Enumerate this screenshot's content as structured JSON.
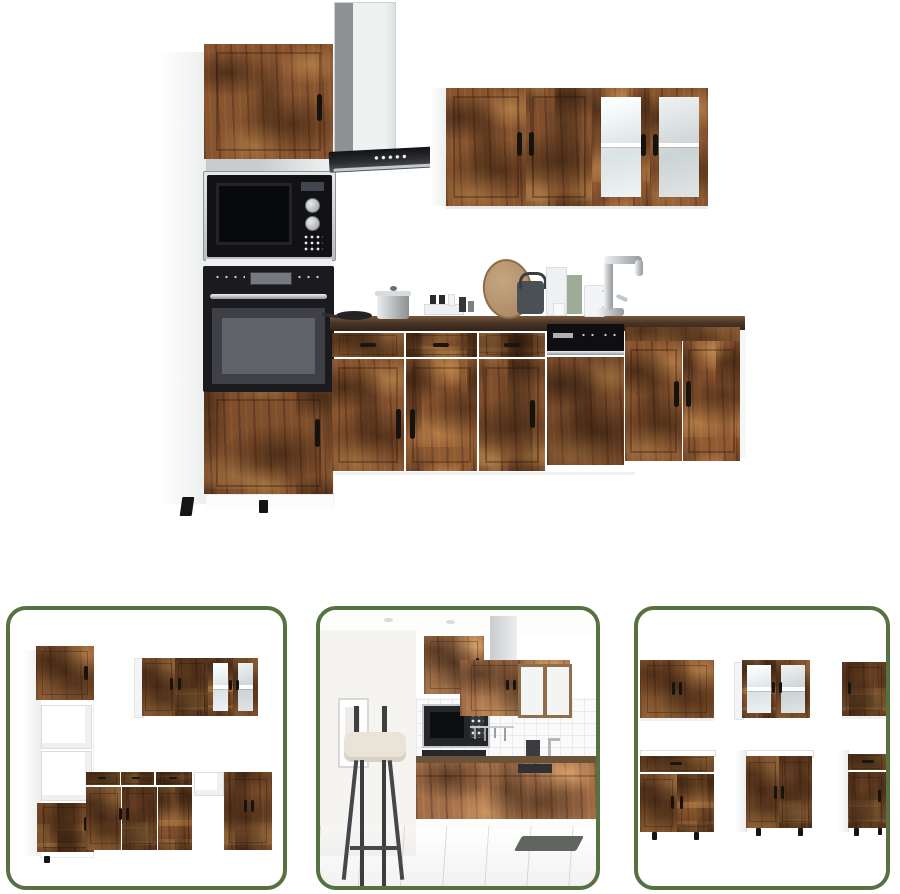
{
  "page": {
    "kind": "product-image-gallery",
    "background": "#ffffff"
  },
  "palette": {
    "green": "#567240",
    "wood_mid": "#875430",
    "counter_dark": "#4a3626",
    "appliance_black": "#141417",
    "steel": "#c9cdcf"
  },
  "main_image": {
    "alt": "Kitchen cabinet set in rustic smoked-oak wood with built-in microwave, oven, cooker hood, dishwasher, sink and counter accessories on white background"
  },
  "thumbnails": [
    {
      "alt": "Cabinet set arrangement without appliances, open compartments visible"
    },
    {
      "alt": "Kitchen set installed in a room scene with bar stool and wooden floor"
    },
    {
      "alt": "Six individual cabinet units shown separately in two rows"
    }
  ]
}
